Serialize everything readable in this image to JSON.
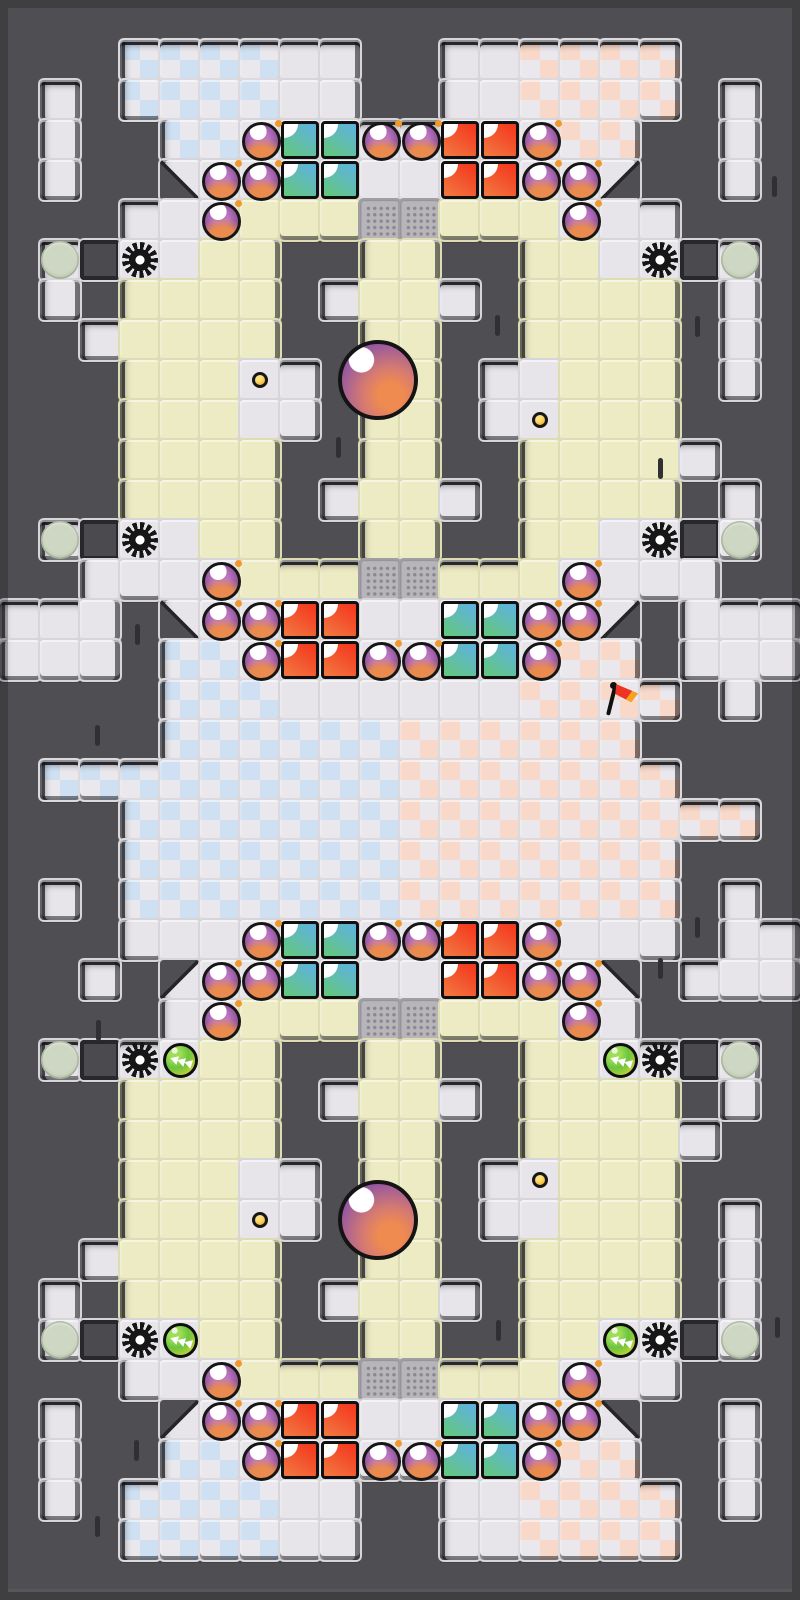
{
  "board": {
    "cols": 20,
    "rows": 40,
    "tile_size": 40,
    "legend": {
      "#": "wall",
      ".": "light-floor",
      "y": "yellow-floor",
      "b": "checker-blue-floor",
      "p": "checker-pink-floor",
      "g": "grate-floor",
      "o": "obstacle-block",
      "1": "diagonal-wall-sw",
      "2": "diagonal-wall-se",
      "3": "diagonal-wall-nw",
      "4": "diagonal-wall-ne"
    },
    "map": [
      "####################",
      "###bbbb..##..pppp###",
      "#.#bbbb..##..pppp#.#",
      "#.##bb........pp##.#",
      "#.##1..........2##.#",
      "###...yyyggyyy...###",
      "#.o..yy##yy##yy..o.#",
      "#.#yyyy#.yy.#yyyy#.#",
      "##.yyyy##yy##yyyy#.#",
      "###yyy..#yy#..yyy#.#",
      "###yyy..#yy#..yyy###",
      "###yyyy##yy##yyyy.##",
      "###yyyy#.yy.#yyyy#.#",
      "#.o..yy##yy##yy..o.#",
      "##....yyyggyyy....##",
      "...#1..........2#...",
      "...#bb........pp#...",
      "####bbb......pppp#.#",
      "####bbbbbbpppppp####",
      "#bbbbbbbbbppppppp###",
      "###bbbbbbbppppppppp#",
      "###bbbbbbbppppppp###",
      "#.#bbbbbbbppppppp#.#",
      "###..............#..",
      "##.#3..........4#...",
      "####..yyyggyyy..####",
      "#.o..yy##yy##yy..o.#",
      "###yyyy#.yy.#yyyy#.#",
      "###yyyy##yy##yyyy.##",
      "###yyy..#yy#..yyy###",
      "###yyy..#yy#..yyy#.#",
      "##.yyyy##yy##yyyy#.#",
      "#.#yyyy#.yy.#yyyy#.#",
      "#.o..yy##yy##yy..o.#",
      "###...yyyggyyy...###",
      "#.##3..........4##.#",
      "#.##bb........pp##.#",
      "#.#bbbb..##..pppp#.#",
      "###bbbb..##..pppp###",
      "####################"
    ]
  },
  "colors": {
    "wall": "#4f4f53",
    "frame": "#3e3e42",
    "floor": "#e7e5e9",
    "yellow": "#edebc4",
    "checker_blue": "#cfe0f2",
    "checker_pink": "#f8d8c8",
    "checker_plain": "#eae8ec",
    "grate": "#b7b5b9",
    "crate_red": "#f43a20",
    "crate_teal": "#5fb3da",
    "bomb_purple": "#9a5aa4",
    "orb_purple": "#7b4b92",
    "orb_orange": "#ef8a50",
    "button_green": "#6cc43e",
    "coin_yellow": "#f6b821",
    "flag_red": "#ee3224"
  },
  "entities": {
    "bombs": [
      [
        6,
        3
      ],
      [
        9,
        3
      ],
      [
        10,
        3
      ],
      [
        13,
        3
      ],
      [
        5,
        4
      ],
      [
        6,
        4
      ],
      [
        13,
        4
      ],
      [
        14,
        4
      ],
      [
        5,
        5
      ],
      [
        14,
        5
      ],
      [
        5,
        14
      ],
      [
        14,
        14
      ],
      [
        5,
        15
      ],
      [
        6,
        15
      ],
      [
        13,
        15
      ],
      [
        14,
        15
      ],
      [
        6,
        16
      ],
      [
        9,
        16
      ],
      [
        10,
        16
      ],
      [
        13,
        16
      ],
      [
        6,
        23
      ],
      [
        9,
        23
      ],
      [
        10,
        23
      ],
      [
        13,
        23
      ],
      [
        5,
        24
      ],
      [
        6,
        24
      ],
      [
        13,
        24
      ],
      [
        14,
        24
      ],
      [
        5,
        25
      ],
      [
        14,
        25
      ],
      [
        5,
        34
      ],
      [
        14,
        34
      ],
      [
        5,
        35
      ],
      [
        6,
        35
      ],
      [
        13,
        35
      ],
      [
        14,
        35
      ],
      [
        6,
        36
      ],
      [
        9,
        36
      ],
      [
        10,
        36
      ],
      [
        13,
        36
      ]
    ],
    "crates": [
      {
        "col": 7,
        "row": 3,
        "color": "teal"
      },
      {
        "col": 11,
        "row": 3,
        "color": "red"
      },
      {
        "col": 7,
        "row": 15,
        "color": "red"
      },
      {
        "col": 11,
        "row": 15,
        "color": "teal"
      },
      {
        "col": 7,
        "row": 23,
        "color": "teal"
      },
      {
        "col": 11,
        "row": 23,
        "color": "red"
      },
      {
        "col": 7,
        "row": 35,
        "color": "red"
      },
      {
        "col": 11,
        "row": 35,
        "color": "teal"
      }
    ],
    "gears": [
      [
        3,
        6
      ],
      [
        16,
        6
      ],
      [
        3,
        13
      ],
      [
        16,
        13
      ],
      [
        3,
        26
      ],
      [
        16,
        26
      ],
      [
        3,
        33
      ],
      [
        16,
        33
      ]
    ],
    "spawn_pads": [
      [
        1,
        6
      ],
      [
        18,
        6
      ],
      [
        1,
        13
      ],
      [
        18,
        13
      ],
      [
        1,
        26
      ],
      [
        18,
        26
      ],
      [
        1,
        33
      ],
      [
        18,
        33
      ]
    ],
    "boost_buttons": [
      [
        4,
        26
      ],
      [
        15,
        26
      ],
      [
        4,
        33
      ],
      [
        15,
        33
      ]
    ],
    "coins": [
      [
        6,
        9
      ],
      [
        13,
        10
      ],
      [
        13,
        29
      ],
      [
        6,
        30
      ]
    ],
    "flag": {
      "col": 15,
      "row": 17
    },
    "orbs": [
      {
        "x": 378,
        "y": 380
      },
      {
        "x": 378,
        "y": 1220
      }
    ],
    "cracks": [
      [
        338,
        447
      ],
      [
        497,
        325
      ],
      [
        697,
        326
      ],
      [
        660,
        468
      ],
      [
        137,
        634
      ],
      [
        774,
        186
      ],
      [
        97,
        735
      ],
      [
        697,
        927
      ],
      [
        660,
        968
      ],
      [
        98,
        1030
      ],
      [
        498,
        1330
      ],
      [
        777,
        1327
      ],
      [
        136,
        1450
      ],
      [
        97,
        1526
      ]
    ]
  }
}
